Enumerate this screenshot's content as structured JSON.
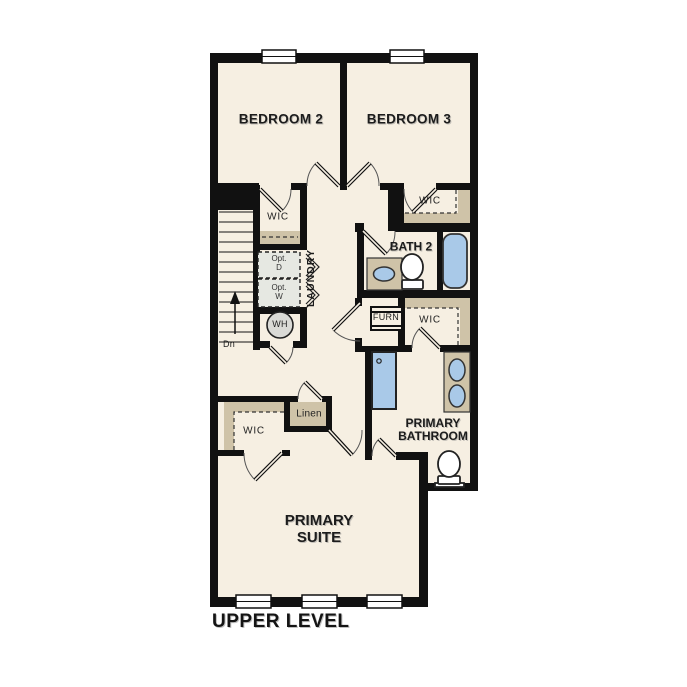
{
  "title": {
    "level": "UPPER LEVEL"
  },
  "labels": {
    "bedroom2": "BEDROOM 2",
    "bedroom3": "BEDROOM 3",
    "wic": "WIC",
    "bath2": "BATH 2",
    "laundry": "LAUNDRY",
    "opt_line": "Opt.",
    "opt_d": "D",
    "opt_w": "W",
    "water_heater": "WH",
    "furnace": "FURN",
    "linen": "Linen",
    "primary_bath_1": "PRIMARY",
    "primary_bath_2": "BATHROOM",
    "primary_suite_1": "PRIMARY",
    "primary_suite_2": "SUITE",
    "stairs_down": "Dn"
  },
  "colors": {
    "wall": "#111111",
    "floor": "#f6efe2",
    "closet_tan": "#cfc3a8",
    "fixture_blue": "#a9c9e8",
    "appliance_gray": "#e6e8e2",
    "background": "#ffffff"
  }
}
